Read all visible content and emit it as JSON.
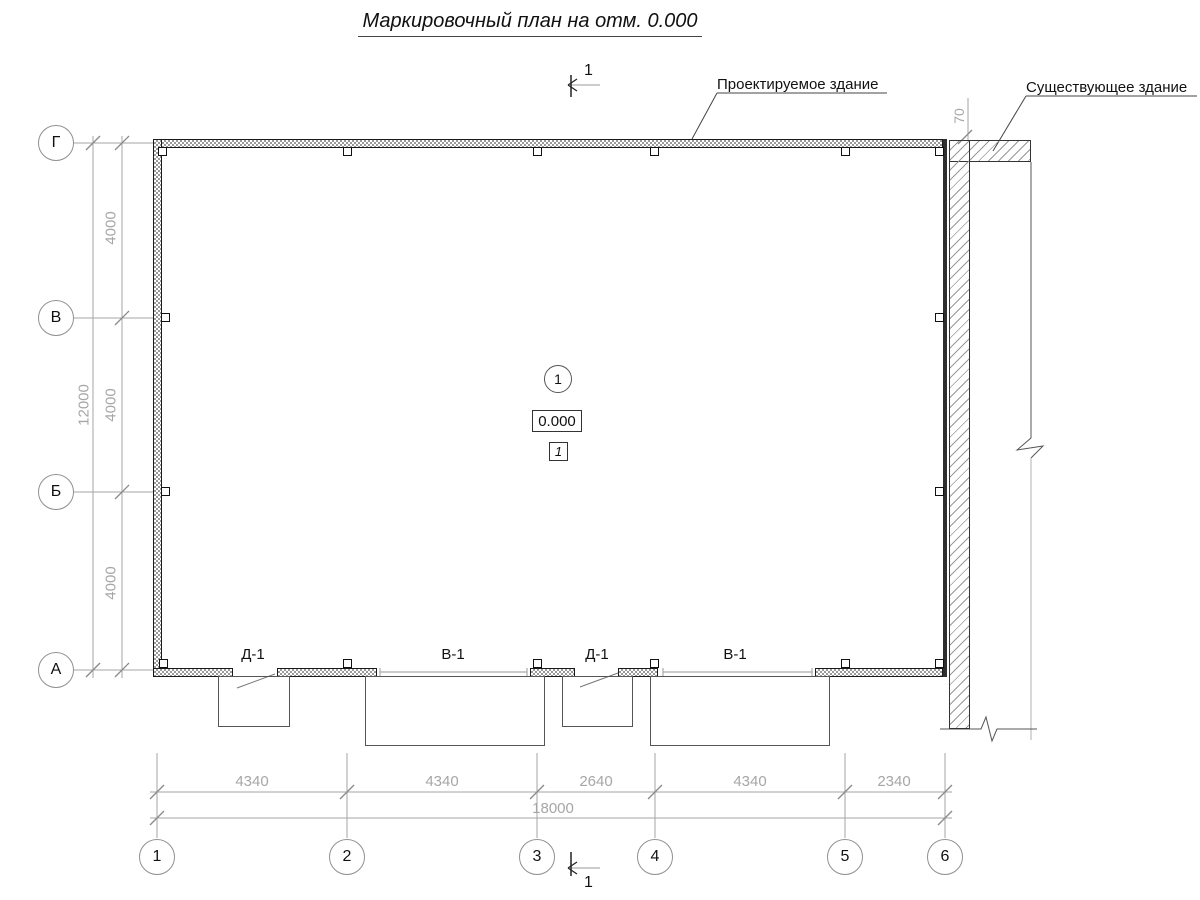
{
  "title": "Маркировочный план на отм. 0.000",
  "annotations": {
    "projected_building": "Проектируемое здание",
    "existing_building": "Существующее здание",
    "gap_dimension": "70",
    "section_label_top": "1",
    "section_label_bottom": "1"
  },
  "room_markers": {
    "axis_bubble": "1",
    "elevation": "0.000",
    "room_number": "1"
  },
  "opening_labels": [
    "Д-1",
    "В-1",
    "Д-1",
    "В-1"
  ],
  "axes": {
    "rows": [
      "Г",
      "В",
      "Б",
      "А"
    ],
    "columns": [
      "1",
      "2",
      "3",
      "4",
      "5",
      "6"
    ]
  },
  "dimensions": {
    "left_segments": [
      "4000",
      "4000",
      "4000"
    ],
    "left_total": "12000",
    "bottom_segments": [
      "4340",
      "4340",
      "2640",
      "4340",
      "2340"
    ],
    "bottom_total": "18000"
  },
  "colors": {
    "line_dark": "#1a1a1a",
    "outline_medium": "#555555",
    "dimension_gray": "#a6a6a6",
    "hatch_gray": "#999999"
  }
}
